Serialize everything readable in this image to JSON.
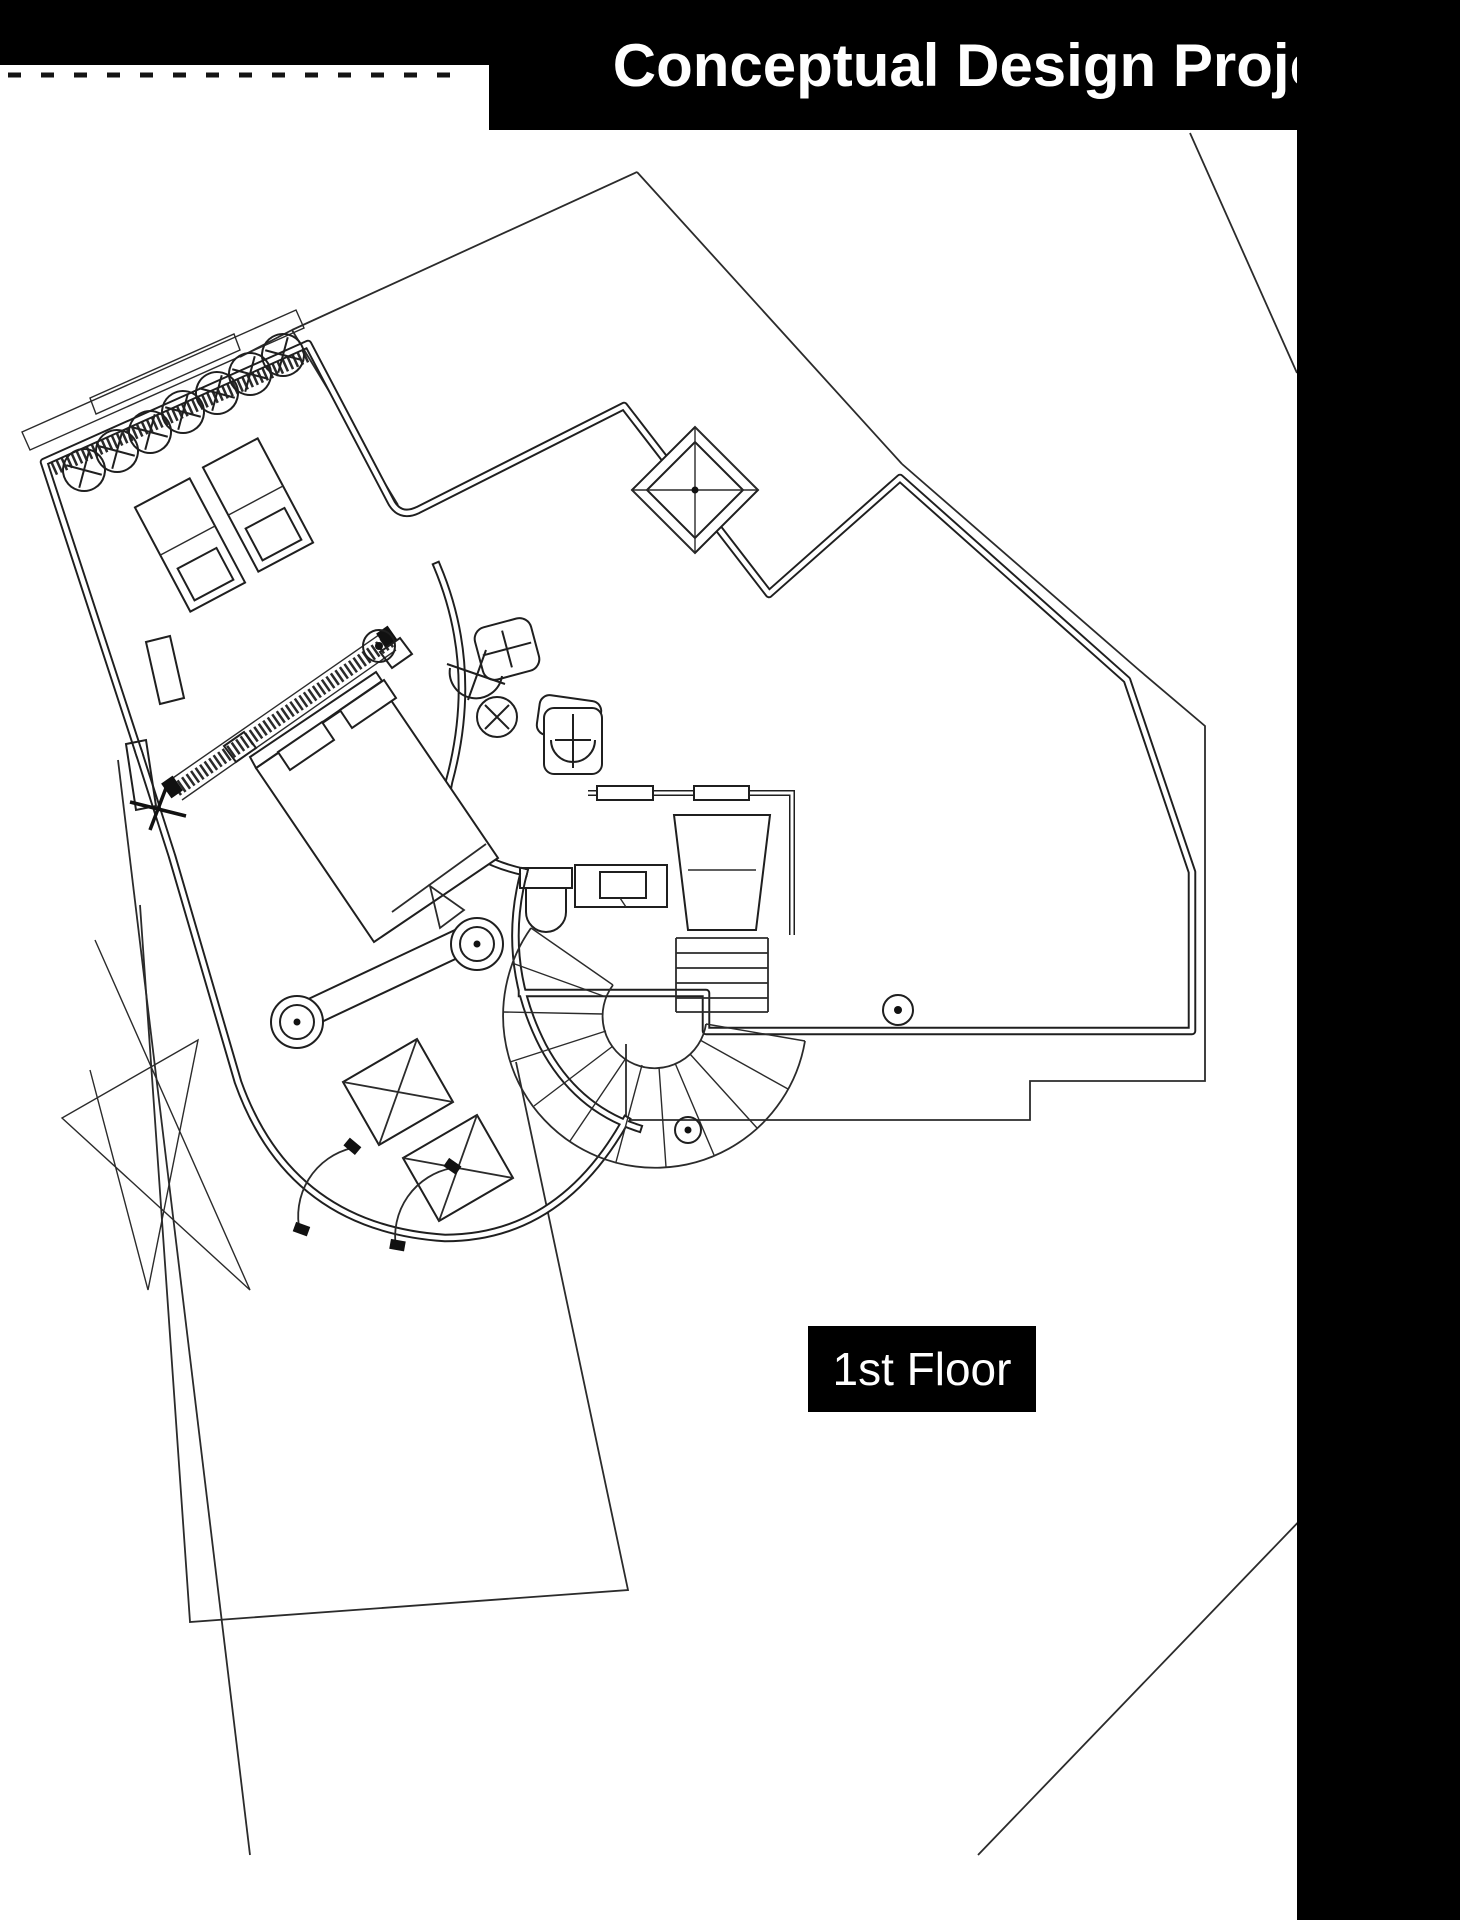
{
  "header": {
    "title": "Conceptual Design Project"
  },
  "floor_tag": {
    "label": "1st Floor"
  },
  "colors": {
    "banner_bg": "#000000",
    "title_text": "#ffffff",
    "label_bg": "#000000",
    "label_text": "#ffffff",
    "page_bg": "#ffffff",
    "drawing_line": "#1f1f1f"
  },
  "plan": {
    "type": "architectural-floor-plan",
    "elements": [
      "roof-outline",
      "entry-skylight-diamond",
      "sunroom-wing",
      "round-skylight-circles",
      "lounger-beds",
      "master-bed",
      "vanity-bench-with-stools",
      "crossed-wardrobe-boxes",
      "glazed-wall-hatching",
      "curved-corridor-wall",
      "bathroom-fixtures",
      "spiral-staircase",
      "dressing-room",
      "terrace-outline",
      "site-boundary-lines",
      "door-swings",
      "column-markers"
    ]
  }
}
